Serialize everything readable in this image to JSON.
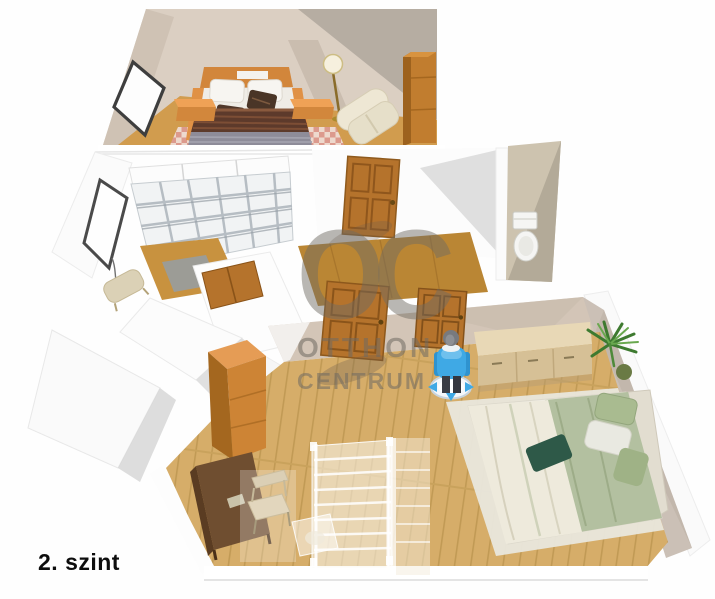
{
  "floor_label": "2. szint",
  "watermark": {
    "logo": "OC",
    "line1": "OTTHON",
    "line2": "CENTRUM"
  },
  "palette": {
    "background": "#fefefe",
    "wall_tan": "#dbcfc2",
    "wall_tan_dark": "#cfc2b4",
    "wall_shadow": "#b1a89f",
    "wall_white": "#fbfbfb",
    "wall_gray_shade": "#d8d8d8",
    "wall_lower_tan": "#d3c5b7",
    "wall_lower_right": "#cbc0b6",
    "floor_upper": "#d19c4e",
    "floor_middle": "#c8923f",
    "floor_hall": "#ba8634",
    "floor_oak": "#d6ad69",
    "door_wood": "#b5732c",
    "bed_frame_orange": "#d2863b",
    "duvet_brown": "#5d3a2b",
    "duvet_gray": "#8e8c99",
    "rug_pink": "#dd9a90",
    "sheet_white": "#f1efe8",
    "blanket_sage": "#b3c0a0",
    "cushion_green": "#2e5948",
    "dresser_tan": "#d6c096",
    "wardrobe_orange": "#cd8435",
    "desk_brown": "#6f4e30",
    "avatar_blue": "#3fa9e5",
    "plant_green": "#3e7a30",
    "wc_wall": "#cdc3af",
    "watermark_gray": "#6f6a62"
  },
  "scene": {
    "type": "3d-floorplan-render",
    "levels": [
      {
        "name": "upper-bedroom-strip",
        "items": [
          "window",
          "double-bed",
          "nightstand-left",
          "nightstand-right",
          "floor-lamp",
          "armchair",
          "wardrobe",
          "checkered-rug"
        ]
      },
      {
        "name": "middle-level",
        "items": [
          "window",
          "shelving-unit",
          "floor-mat",
          "side-chair",
          "wood-door",
          "hall-door",
          "wc-toilet"
        ]
      },
      {
        "name": "main-bedroom-level",
        "items": [
          "door-left",
          "door-right",
          "person-figure",
          "dresser",
          "potted-plant",
          "double-bed",
          "wardrobe",
          "desk",
          "desk-chair",
          "ghost-staircase"
        ]
      }
    ]
  }
}
